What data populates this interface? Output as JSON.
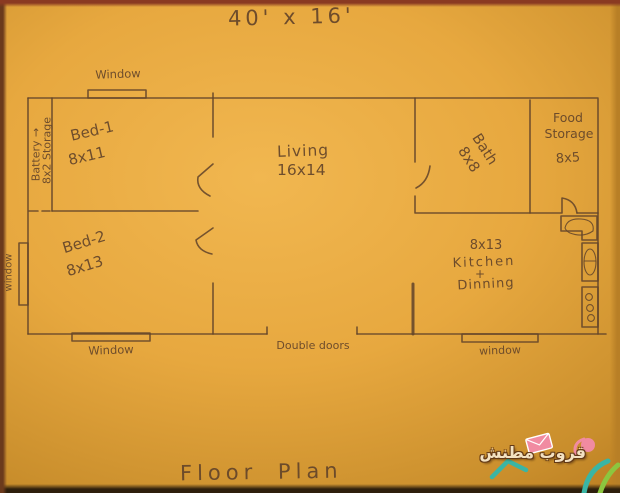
{
  "colors": {
    "paper": "#e7a83f",
    "paper_light": "#f1b750",
    "paper_dark": "#c98e2c",
    "ink": "#64452a",
    "wm_teal": "#3ab5a4",
    "wm_green": "#8cc63f",
    "wm_pink": "#f18ba1",
    "wm_text": "#f7e9cf",
    "wm_outline": "#5a3214"
  },
  "header": {
    "title": "40' x 16'"
  },
  "footer": {
    "caption": "Floor Plan"
  },
  "rooms": {
    "battery": {
      "line1": "Battery →",
      "line2": "8x2 Storage"
    },
    "bed1": {
      "name": "Bed-1",
      "size": "8x11"
    },
    "bed2": {
      "name": "Bed-2",
      "size": "8x13"
    },
    "living": {
      "name": "Living",
      "size": "16x14"
    },
    "bath": {
      "name": "Bath",
      "size": "8x8"
    },
    "food_storage": {
      "name_line1": "Food",
      "name_line2": "Storage",
      "size": "8x5"
    },
    "kitchen": {
      "size": "8x13",
      "name": "Kitchen",
      "joiner": "+",
      "name2": "Dinning"
    }
  },
  "openings": {
    "window_top": "Window",
    "window_left": "window",
    "window_bottom_left": "Window",
    "window_bottom_right": "window",
    "double_doors": "Double doors"
  },
  "watermark": {
    "text": "قروب مطنش"
  }
}
